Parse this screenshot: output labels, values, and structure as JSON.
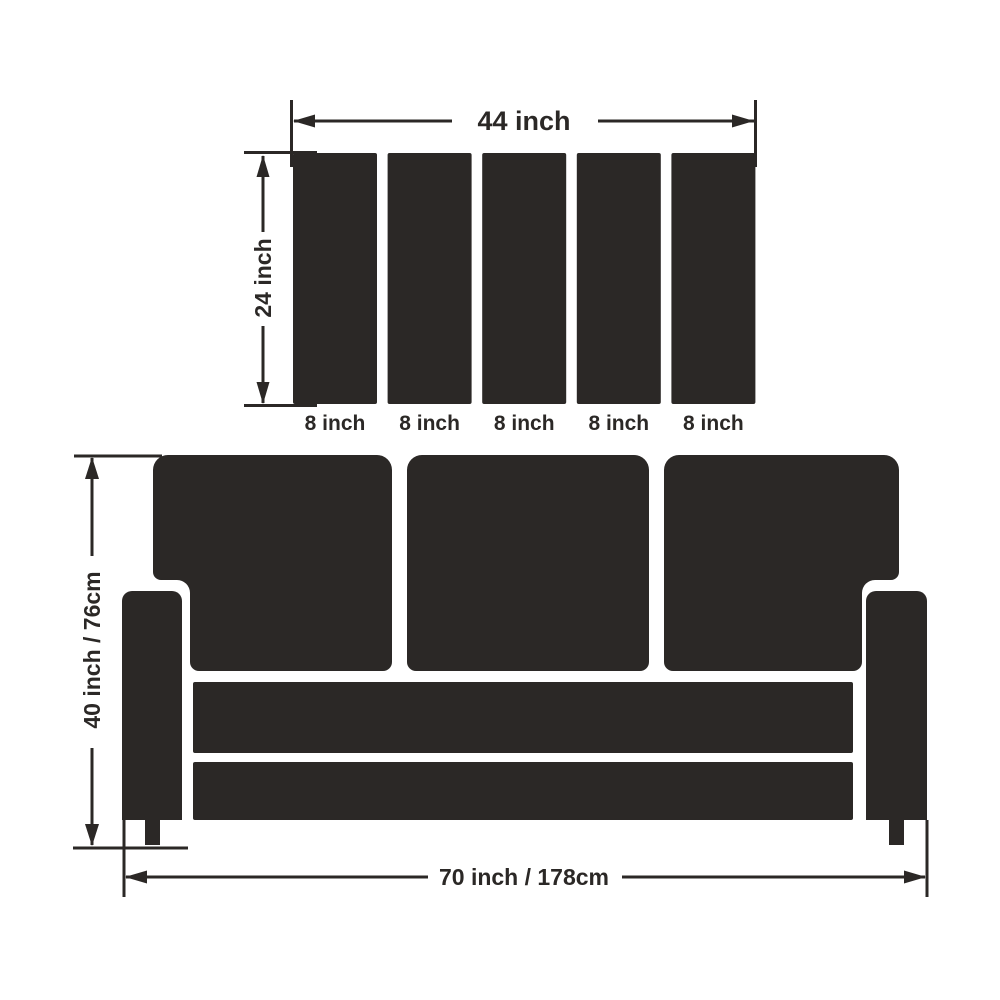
{
  "colors": {
    "ink": "#2b2826",
    "background": "#ffffff"
  },
  "slat_panel": {
    "width_label": "44 inch",
    "height_label": "24 inch",
    "slat_count": 5,
    "slat_labels": [
      "8 inch",
      "8 inch",
      "8 inch",
      "8 inch",
      "8 inch"
    ]
  },
  "sofa": {
    "height_label": "40 inch / 76cm",
    "width_label": "70 inch / 178cm"
  }
}
